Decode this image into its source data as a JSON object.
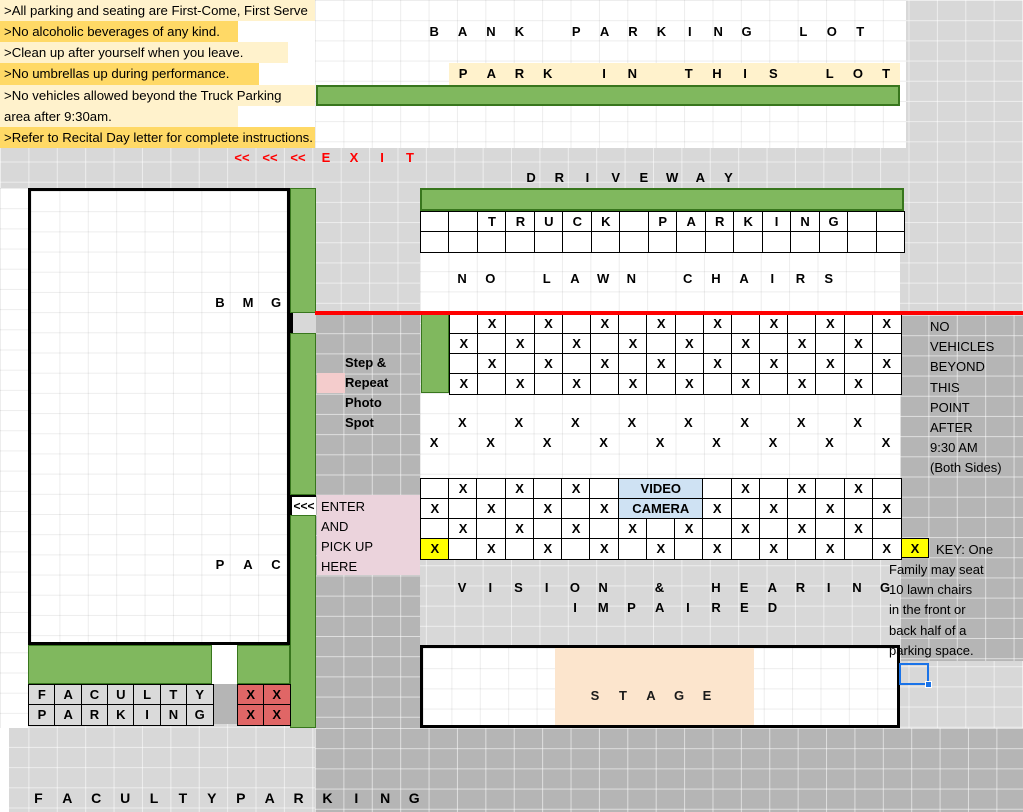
{
  "meta": {
    "title": "Recital Day Parking Map Spreadsheet",
    "canvas_w": 1023,
    "canvas_h": 812
  },
  "colors": {
    "base_gray": "#D8D8D8",
    "road_gray": "#B5B5B5",
    "white": "#FFFFFF",
    "yellow_light": "#FFF2CC",
    "yellow_mid": "#FFD966",
    "yellow_bright": "#FFFF00",
    "green_fill": "#80B85E",
    "green_border": "#38761D",
    "red": "#FF0000",
    "red_cell": "#E06666",
    "pink_light": "#F4CCCC",
    "pink_enter": "#EBD3DC",
    "blue_cell": "#CFE2F3",
    "selection_blue": "#1A73E8",
    "stage_cream": "#FCE5CD",
    "cell_gray": "#DADADA"
  },
  "instructions": {
    "rows": [
      {
        "text": ">All parking and seating are First-Come, First Serve",
        "bg": "#FFF2CC",
        "w": 315
      },
      {
        "text": ">No alcoholic beverages of any kind.",
        "bg": "#FFD966",
        "w": 238
      },
      {
        "text": ">Clean up after yourself when you leave.",
        "bg": "#FFF2CC",
        "w": 288
      },
      {
        "text": ">No umbrellas up during performance.",
        "bg": "#FFD966",
        "w": 259
      },
      {
        "text": ">No vehicles allowed beyond the Truck Parking",
        "bg": "#FFF2CC",
        "w": 315
      },
      {
        "text": "area after 9:30am.",
        "bg": "#FFF2CC",
        "w": 238
      },
      {
        "text": ">Refer to Recital Day letter for complete instructions.",
        "bg": "#FFD966",
        "w": 315
      }
    ],
    "row_h": 21.15
  },
  "rects": [
    {
      "name": "bank-lot-white-area",
      "x": 315,
      "y": 0,
      "w": 591,
      "h": 148,
      "bg": "#FFFFFF",
      "grid": "white"
    },
    {
      "name": "road-middle",
      "x": 315,
      "y": 313,
      "w": 105,
      "h": 477,
      "bg": "#B5B5B5",
      "grid": "gray"
    },
    {
      "name": "road-right",
      "x": 900,
      "y": 315,
      "w": 123,
      "h": 346,
      "bg": "#B5B5B5",
      "grid": "gray"
    },
    {
      "name": "road-bottom",
      "x": 315,
      "y": 728,
      "w": 708,
      "h": 84,
      "bg": "#B5B5B5",
      "grid": "gray"
    },
    {
      "name": "left-white-margin",
      "x": 0,
      "y": 188,
      "w": 28,
      "h": 540,
      "bg": "#FFFFFF",
      "grid": "white"
    },
    {
      "name": "bottom-left-white-margin",
      "x": 0,
      "y": 728,
      "w": 9,
      "h": 84,
      "bg": "#FFFFFF"
    },
    {
      "name": "building-bmg-pac",
      "x": 28,
      "y": 188,
      "w": 262,
      "h": 457,
      "bg": "#FFFFFF",
      "grid": "white",
      "border": "3px solid #000"
    },
    {
      "name": "no-lawn-chairs-white-band",
      "x": 420,
      "y": 251,
      "w": 480,
      "h": 62,
      "bg": "#FFFFFF",
      "grid": "white"
    },
    {
      "name": "open-lawn-white-band",
      "x": 420,
      "y": 393,
      "w": 480,
      "h": 85,
      "bg": "#FFFFFF",
      "grid": "white"
    },
    {
      "name": "park-in-this-lot-yellow-band",
      "x": 449,
      "y": 63,
      "w": 451,
      "h": 22,
      "bg": "#FFF2CC"
    },
    {
      "name": "green-bar-top",
      "x": 316,
      "y": 85,
      "w": 584,
      "h": 21,
      "bg": "#80B85E",
      "border": "2px solid #38761D"
    },
    {
      "name": "green-bar-driveway",
      "x": 420,
      "y": 188,
      "w": 484,
      "h": 23,
      "bg": "#80B85E",
      "border": "2px solid #38761D"
    },
    {
      "name": "green-strip-upper",
      "x": 290,
      "y": 188,
      "w": 26,
      "h": 125,
      "bg": "#80B85E",
      "border": "1.5px solid #38761D"
    },
    {
      "name": "green-strip-gap-cell",
      "x": 290,
      "y": 313,
      "w": 26,
      "h": 20,
      "bg": "#D8D8D8",
      "border_left": "3px solid #000"
    },
    {
      "name": "green-strip-mid",
      "x": 290,
      "y": 333,
      "w": 26,
      "h": 162,
      "bg": "#80B85E",
      "border": "1.5px solid #38761D"
    },
    {
      "name": "green-strip-lower",
      "x": 290,
      "y": 515,
      "w": 26,
      "h": 213,
      "bg": "#80B85E",
      "border": "1.5px solid #38761D"
    },
    {
      "name": "block1-green-cell",
      "x": 421,
      "y": 313,
      "w": 28,
      "h": 80,
      "bg": "#80B85E",
      "border": "1.5px solid #38761D"
    },
    {
      "name": "step-repeat-pink-cell",
      "x": 317,
      "y": 373,
      "w": 28,
      "h": 20,
      "bg": "#F4CCCC"
    },
    {
      "name": "enter-pink-area",
      "x": 317,
      "y": 495,
      "w": 103,
      "h": 80,
      "bg": "#EBD3DC"
    },
    {
      "name": "faculty-green-band-left",
      "x": 28,
      "y": 645,
      "w": 184,
      "h": 39,
      "bg": "#80B85E",
      "border": "1.5px solid #38761D"
    },
    {
      "name": "faculty-band-white-gap",
      "x": 212,
      "y": 645,
      "w": 25,
      "h": 39,
      "bg": "#FFFFFF"
    },
    {
      "name": "faculty-green-band-right",
      "x": 237,
      "y": 645,
      "w": 53,
      "h": 39,
      "bg": "#80B85E",
      "border": "1.5px solid #38761D"
    },
    {
      "name": "faculty-gray-gap-cell",
      "x": 212,
      "y": 684,
      "w": 25,
      "h": 40,
      "bg": "#B5B5B5"
    },
    {
      "name": "stage-box",
      "x": 420,
      "y": 645,
      "w": 480,
      "h": 83,
      "bg": "#FFFFFF",
      "grid": "white",
      "border": "3px solid #000"
    },
    {
      "name": "stage-cream-center",
      "x": 555,
      "y": 648,
      "w": 199,
      "h": 77,
      "bg": "#FCE5CD"
    }
  ],
  "enter_gap_cell": {
    "x": 290,
    "y": 495,
    "w": 26,
    "h": 20,
    "text": "<<<"
  },
  "key_yellow_cell": {
    "x": 901,
    "y": 538,
    "w": 28,
    "h": 20,
    "text": "X"
  },
  "red_line": {
    "x": 315,
    "y": 311,
    "w": 708,
    "h": 4
  },
  "letter_runs": [
    {
      "name": "bank-parking-lot-label",
      "x": 420,
      "y": 21,
      "h": 22,
      "pitch": 28.4,
      "cells": "BANK PARKING LOT",
      "color": "#000",
      "size": 13
    },
    {
      "name": "park-in-this-lot-label",
      "x": 449,
      "y": 63,
      "h": 22,
      "pitch": 28.2,
      "cells": "PARK IN THIS LOT",
      "color": "#000",
      "size": 13
    },
    {
      "name": "exit-label",
      "x": 228,
      "y": 148,
      "h": 20,
      "pitch": 28,
      "cells_arr": [
        "<<",
        "<<",
        "<<",
        "E",
        "X",
        "I",
        "T"
      ],
      "color": "#FF0000",
      "size": 13
    },
    {
      "name": "driveway-label",
      "x": 517,
      "y": 168,
      "h": 20,
      "pitch": 28.2,
      "cells": "DRIVEWAY",
      "color": "#000",
      "size": 13
    },
    {
      "name": "no-lawn-chairs-label",
      "x": 448,
      "y": 269,
      "h": 20,
      "pitch": 28.2,
      "cells": "NO LAWN CHAIRS",
      "color": "#000",
      "size": 13
    },
    {
      "name": "bmg-label",
      "x": 206,
      "y": 293,
      "h": 20,
      "pitch": 28,
      "cells": "BMG",
      "color": "#000",
      "size": 13
    },
    {
      "name": "open-lawn-x-row-even",
      "x": 420,
      "y": 413,
      "h": 20,
      "pitch": 28.24,
      "cells": "_X_X_X_X_X_X_X_X_",
      "color": "#000",
      "size": 13
    },
    {
      "name": "open-lawn-x-row-odd",
      "x": 420,
      "y": 433,
      "h": 20,
      "pitch": 28.24,
      "cells": "X_X_X_X_X_X_X_X_X",
      "color": "#000",
      "size": 13
    },
    {
      "name": "pac-label",
      "x": 206,
      "y": 555,
      "h": 20,
      "pitch": 28,
      "cells": "PAC",
      "color": "#000",
      "size": 13
    },
    {
      "name": "vision-hearing-label",
      "x": 448,
      "y": 578,
      "h": 20,
      "pitch": 28.2,
      "cells": "VISION & HEARING",
      "color": "#000",
      "size": 13
    },
    {
      "name": "impaired-label",
      "x": 561,
      "y": 598,
      "h": 20,
      "pitch": 28.2,
      "cells": "IMPAIRED",
      "color": "#000",
      "size": 13
    },
    {
      "name": "stage-label",
      "x": 581,
      "y": 686,
      "h": 20,
      "pitch": 28,
      "cells": "STAGE",
      "color": "#1a1a1a",
      "size": 13
    },
    {
      "name": "faculty-parking-bottom-label",
      "x": 24,
      "y": 788,
      "h": 20,
      "pitch": 28.9,
      "cells": "FACULTYPARKING",
      "color": "#000",
      "size": 14
    }
  ],
  "text_blocks": [
    {
      "name": "step-repeat-photo-spot-label",
      "x": 345,
      "y": 353,
      "lh": 20,
      "bold": true,
      "size": 13,
      "lines": [
        "Step &",
        "Repeat",
        "Photo",
        "Spot"
      ]
    },
    {
      "name": "enter-pickup-label",
      "x": 321,
      "y": 497,
      "lh": 20,
      "bold": false,
      "size": 13,
      "lines": [
        "ENTER",
        "AND",
        "PICK UP",
        "HERE"
      ]
    },
    {
      "name": "no-vehicles-note",
      "x": 930,
      "y": 317,
      "lh": 20.2,
      "bold": false,
      "size": 13,
      "lines": [
        "NO",
        "VEHICLES",
        "BEYOND",
        "THIS",
        "POINT",
        "AFTER",
        "9:30 AM",
        "(Both Sides)"
      ]
    },
    {
      "name": "key-title",
      "x": 936,
      "y": 540,
      "lh": 20,
      "bold": false,
      "size": 13,
      "lines": [
        "KEY: One"
      ]
    },
    {
      "name": "key-note",
      "x": 889,
      "y": 560,
      "lh": 20.2,
      "bold": false,
      "size": 13,
      "lines": [
        "Family may seat",
        "10 lawn chairs",
        "in the front or",
        "back half of a",
        "parking space."
      ]
    }
  ],
  "blocks": [
    {
      "name": "truck-parking-block",
      "x": 420,
      "y": 211,
      "cw": 28.47,
      "ch": 20,
      "rows": [
        "__TRUCK_PARKING__",
        "_________________"
      ]
    },
    {
      "name": "parking-x-block-top",
      "x": 449,
      "y": 313,
      "cw": 28.19,
      "ch": 20,
      "rows": [
        "_X_X_X_X_X_X_X_X",
        "X_X_X_X_X_X_X_X_",
        "_X_X_X_X_X_X_X_X",
        "X_X_X_X_X_X_X_X_"
      ]
    },
    {
      "name": "parking-x-block-video",
      "x": 420,
      "y": 478,
      "cw": 28.24,
      "ch": 20,
      "rows": [
        [
          "",
          "X",
          "",
          "X",
          "",
          "X",
          "",
          {
            "t": "VIDEO",
            "span": 3,
            "bg": "#CFE2F3"
          },
          "",
          "X",
          "",
          "X",
          "",
          "X",
          ""
        ],
        [
          "X",
          "",
          "X",
          "",
          "X",
          "",
          "X",
          {
            "t": "CAMERA",
            "span": 3,
            "bg": "#CFE2F3"
          },
          "X",
          "",
          "X",
          "",
          "X",
          "",
          "X"
        ],
        "_X_X_X_X_X_X_X_X_",
        [
          {
            "t": "X",
            "bg": "#FFFF00"
          },
          "",
          "X",
          "",
          "X",
          "",
          "X",
          "",
          "X",
          "",
          "X",
          "",
          "X",
          "",
          "X",
          "",
          "X"
        ]
      ]
    },
    {
      "name": "faculty-parking-block",
      "x": 28,
      "y": 684,
      "cw": 26.3,
      "ch": 20,
      "cellbg": "#DADADA",
      "rows": [
        "FACULTY",
        "PARKING"
      ]
    },
    {
      "name": "faculty-red-x-block",
      "x": 237,
      "y": 684,
      "cw": 26,
      "ch": 20,
      "cellbg": "#E06666",
      "rows": [
        "XX",
        "XX"
      ]
    }
  ],
  "selection": {
    "name": "active-cell-selection",
    "x": 899,
    "y": 663,
    "w": 30,
    "h": 22
  }
}
